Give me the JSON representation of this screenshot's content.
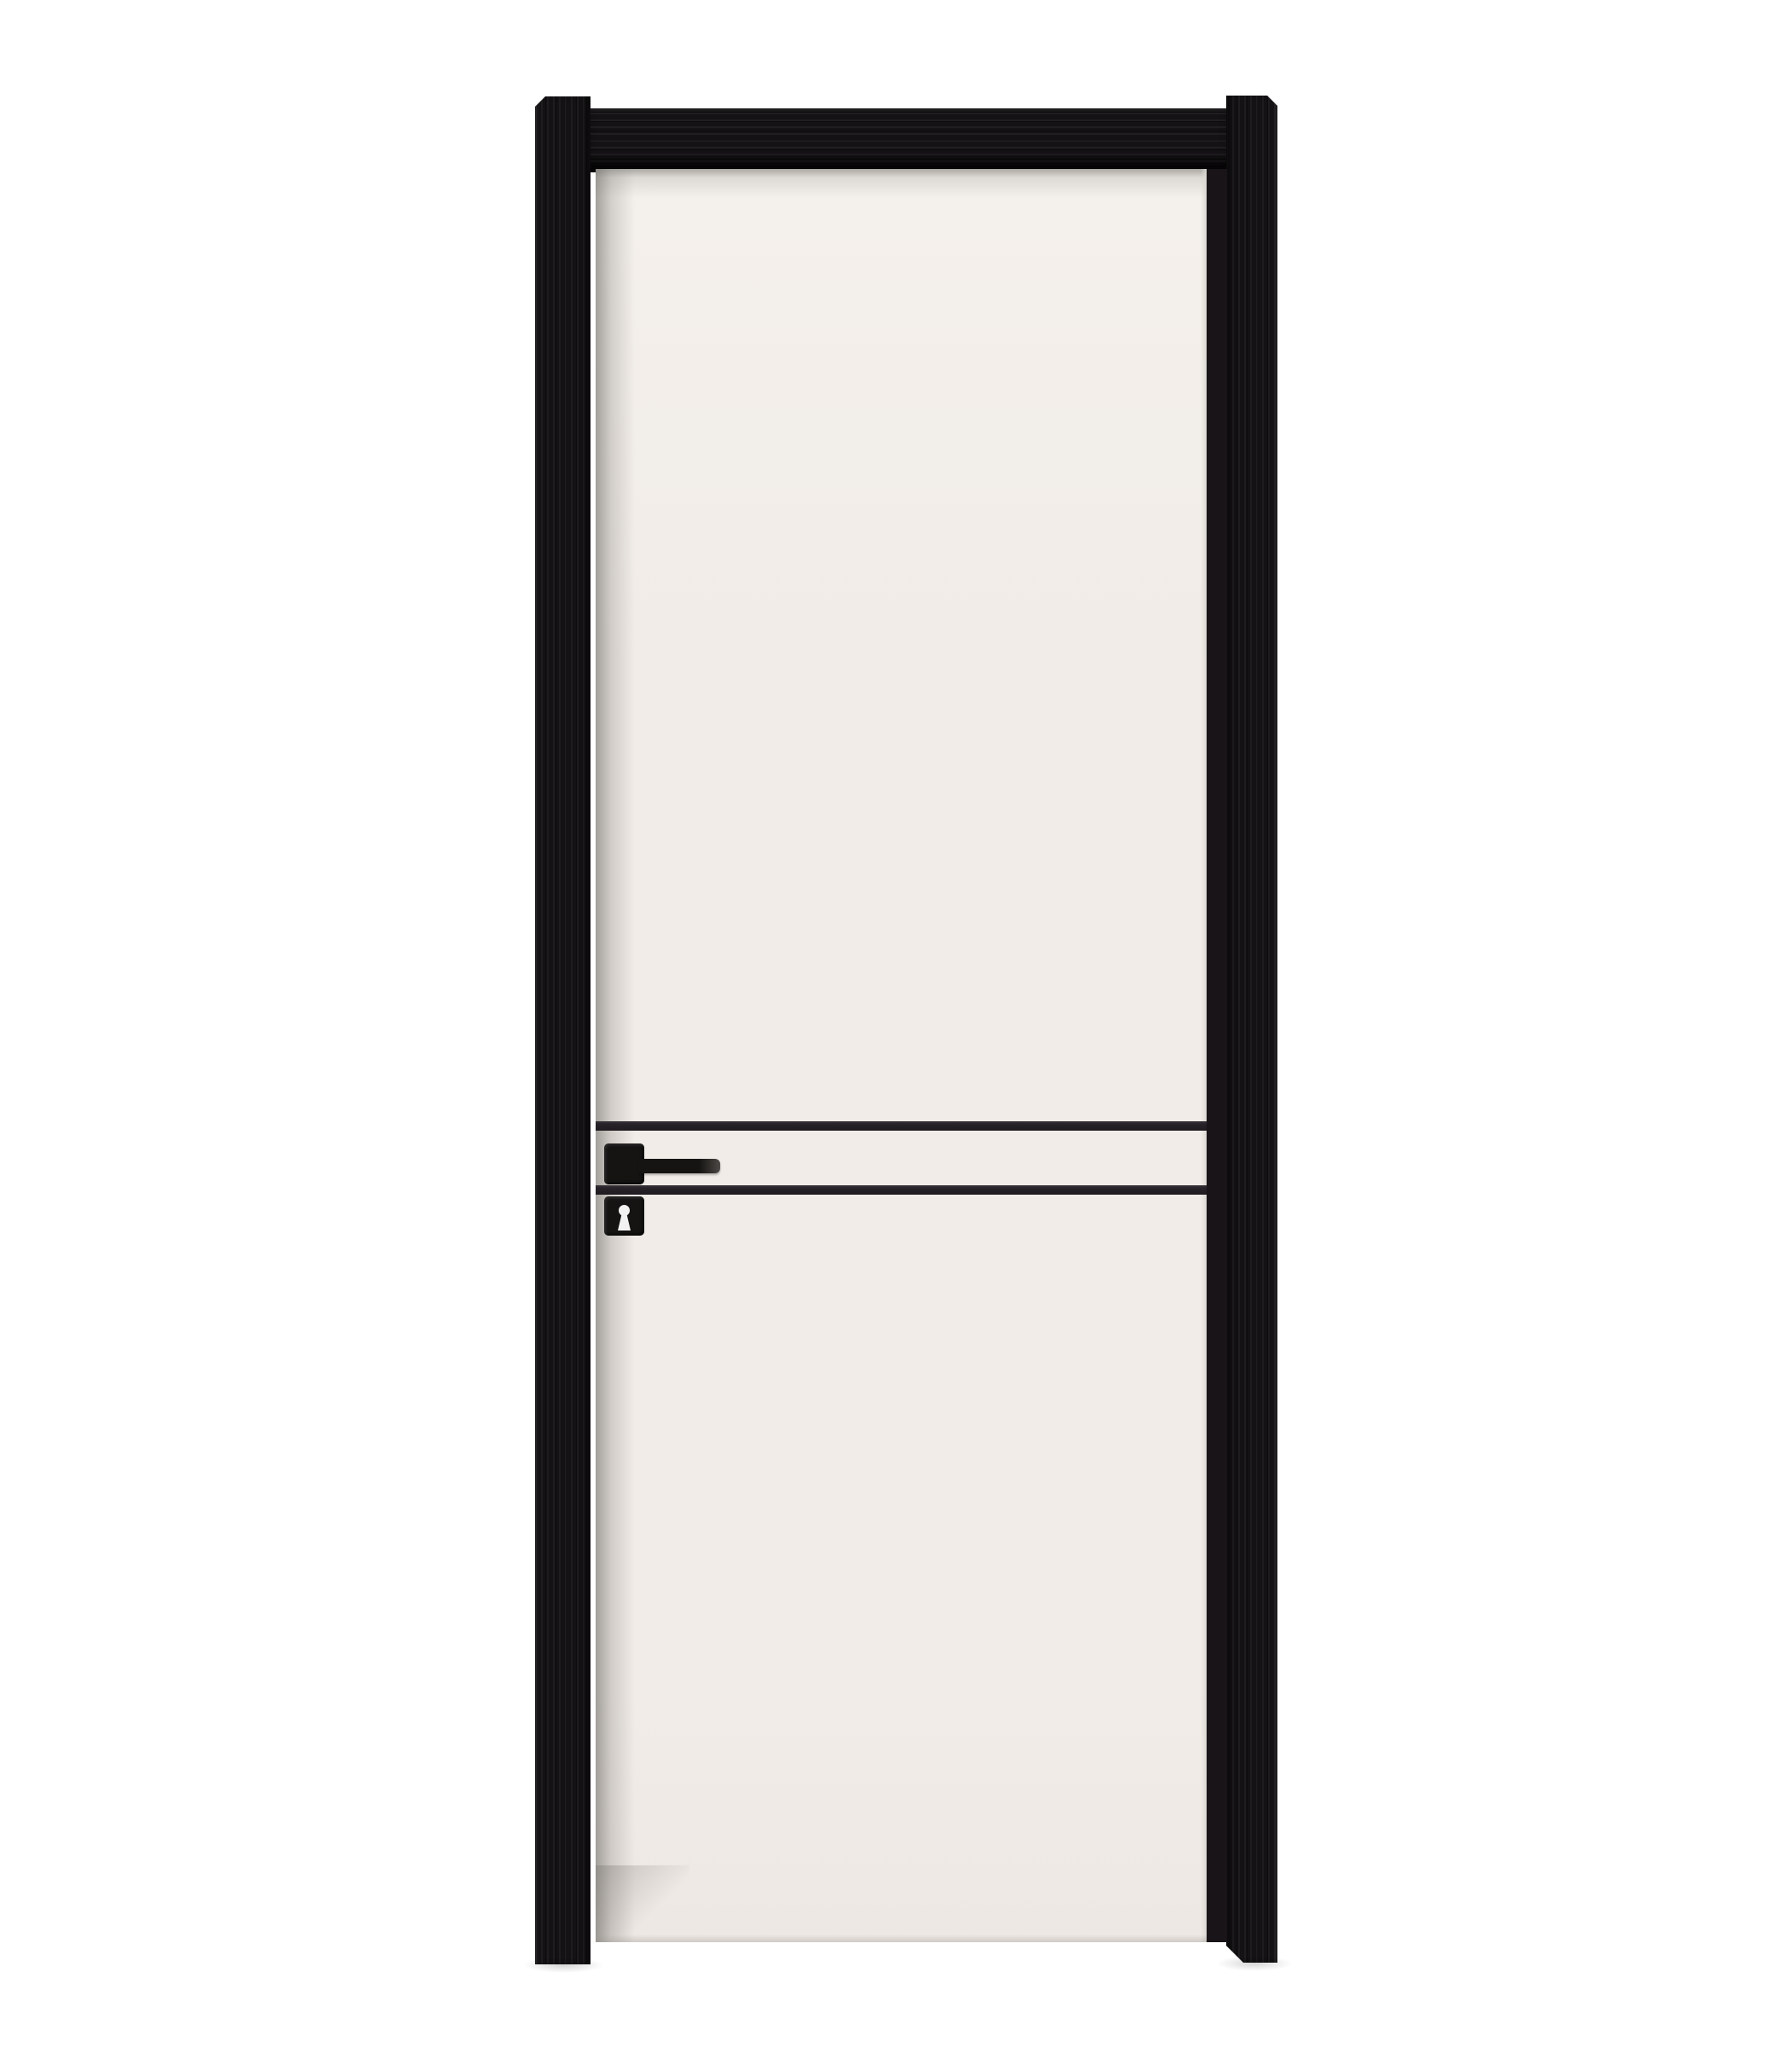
{
  "scene": {
    "type": "product-photo",
    "subject": "white-interior-door-with-black-frame",
    "colors": {
      "background": "#ffffff",
      "frame": "#141214",
      "frame_grain": "#2a272a",
      "frame_edge": "#060606",
      "leaf": "#f1ece8",
      "leaf_top": "#f4f0ec",
      "leaf_shadow": "#9b9892",
      "groove": "#28232a",
      "hardware": "#151413",
      "hardware_tip": "#4e4a47",
      "keyhole": "#f2f2f2",
      "door_stop": "#191417",
      "edge_highlight": "#dbd8d3"
    },
    "components": {
      "frame_left_jamb": "black wood jamb, left",
      "frame_right_jamb": "black wood jamb, right",
      "frame_header": "black wood header rail",
      "door_leaf": "flat off-white door slab",
      "groove_lines": "two thin black horizontal inlay grooves",
      "handle": "black square-rose lever handle",
      "escutcheon": "black square keyhole plate with white keyhole"
    }
  }
}
